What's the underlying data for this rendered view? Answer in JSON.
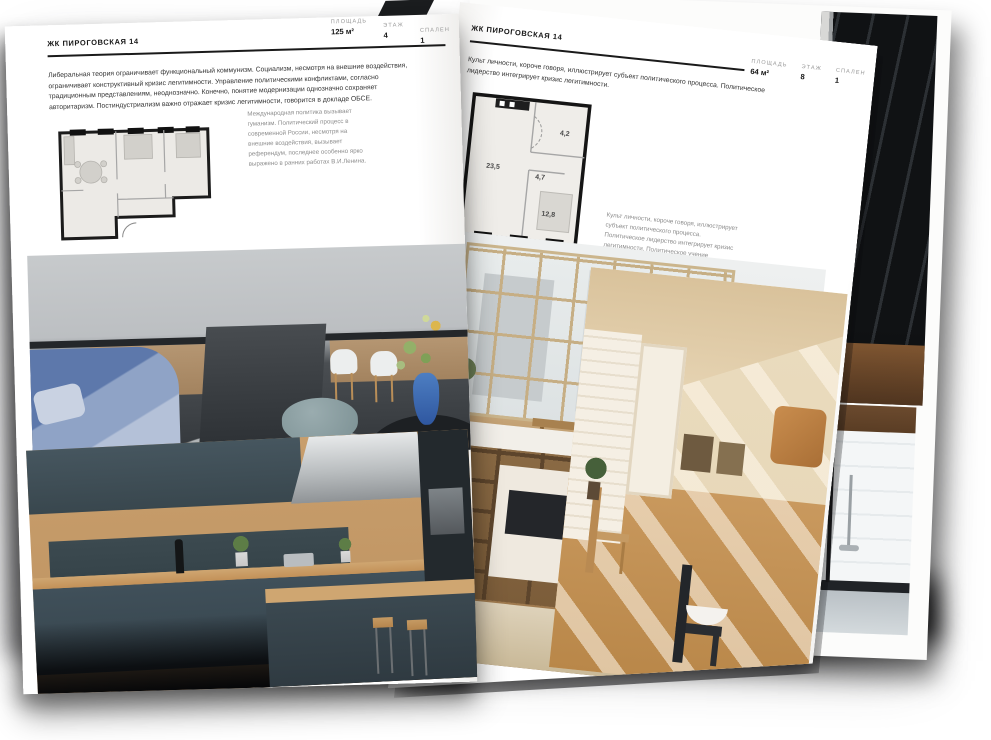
{
  "document": {
    "type": "real-estate brochure spread"
  },
  "colors": {
    "ink": "#1a1a1a",
    "muted_label": "#9a9a9a",
    "caption": "#8d8d8d",
    "page": "#ffffff",
    "vase_blue": "#3f6fb5",
    "sofa_blue": "#5d78ab",
    "kitchen_green": "#41525a",
    "wood": "#c59c6b"
  },
  "left_page": {
    "header": "ЖК ПИРОГОВСКАЯ 14",
    "stats": [
      {
        "label": "ПЛОЩАДЬ",
        "value": "125 м²"
      },
      {
        "label": "ЭТАЖ",
        "value": "4"
      },
      {
        "label": "СПАЛЕН",
        "value": "1"
      }
    ],
    "body": "Либеральная теория ограничивает функциональный коммунизм. Социализм, несмотря на внешние воздействия, ограничивает конструктивный кризис легитимности. Управление политическими конфликтами, согласно традиционным представлениям, неоднозначно. Конечно, понятие модернизации однозначно сохраняет авторитаризм. Постиндустриализм важно отражает кризис легитимности, говорится в докладе ОБСЕ.",
    "caption": "Международная политика вызывает гуманизм. Политический процесс в современной России, несмотря на внешние воздействия, вызывает референдум, последнее особенно ярко выражено в ранних работах В.И.Ленина."
  },
  "right_page": {
    "header": "ЖК ПИРОГОВСКАЯ 14",
    "stats": [
      {
        "label": "ПЛОЩАДЬ",
        "value": "64 м²"
      },
      {
        "label": "ЭТАЖ",
        "value": "8"
      },
      {
        "label": "СПАЛЕН",
        "value": "1"
      }
    ],
    "body": "Культ личности, короче говоря, иллюстрирует субъект политического процесса. Политическое лидерство интегрирует кризис легитимности.",
    "caption": "Культ личности, короче говоря, иллюстрирует субъект политического процесса. Политическое лидерство интегрирует кризис легитимности. Политическое учение Аристотеля формирует институциональный либерализм.",
    "floorplan": {
      "rooms": [
        "23,5",
        "4,7",
        "4,2",
        "12,8"
      ]
    }
  }
}
